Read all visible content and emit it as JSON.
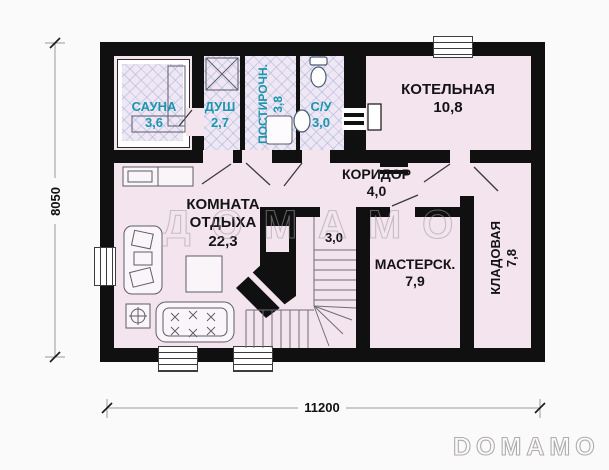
{
  "watermark": {
    "text": "ДОМАМО"
  },
  "brand": {
    "text": "DOMAMO"
  },
  "dimensions": {
    "bottom": "11200",
    "left": "8050"
  },
  "rooms": {
    "sauna": {
      "name": "САУНА",
      "area": "3,6"
    },
    "shower": {
      "name": "ДУШ",
      "area": "2,7"
    },
    "laundry": {
      "name": "ПОСТИРОЧН.",
      "area": "3,8"
    },
    "wc": {
      "name": "С/У",
      "area": "3,0"
    },
    "boiler": {
      "name": "КОТЕЛЬНАЯ",
      "area": "10,8"
    },
    "corridor": {
      "name": "КОРИДОР",
      "area": "4,0"
    },
    "lounge": {
      "name": "КОМНАТА ОТДЫХА",
      "area": "22,3"
    },
    "stairs": {
      "area": "3,0"
    },
    "workshop": {
      "name": "МАСТЕРСК.",
      "area": "7,9"
    },
    "storage": {
      "name": "КЛАДОВАЯ",
      "area": "7,8"
    }
  },
  "colors": {
    "wall": "#101010",
    "floor": "#f3e4ee",
    "hatch_line": "#a0b9dc",
    "wet_label": "#1b96ae",
    "label": "#141414",
    "background": "#fbfafa"
  }
}
